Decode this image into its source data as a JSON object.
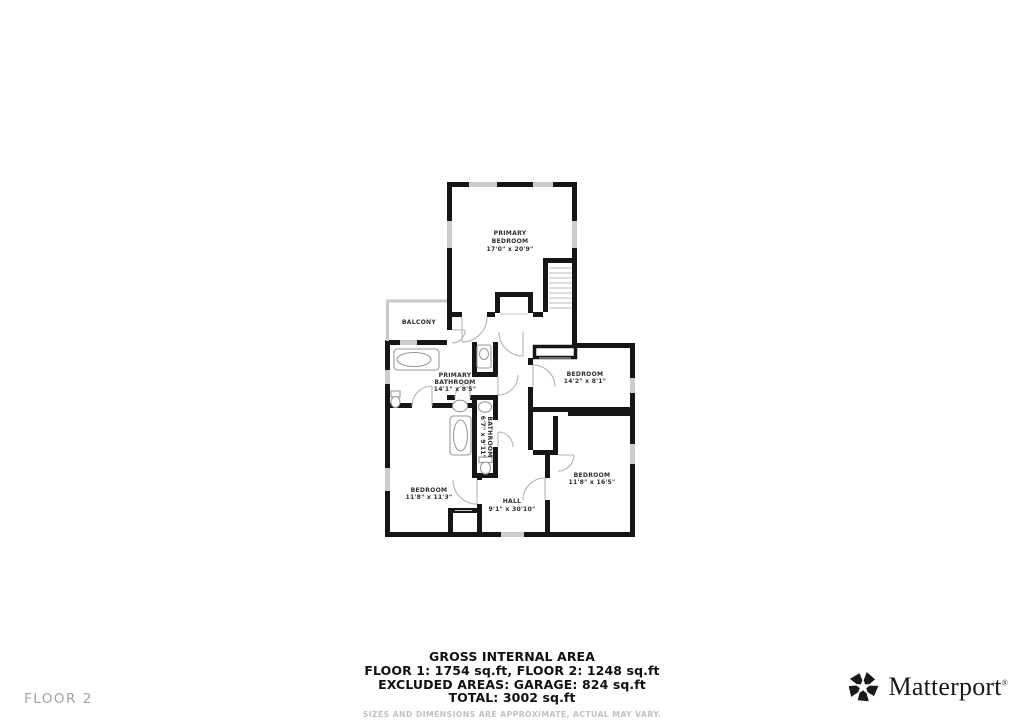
{
  "floor_label": "FLOOR 2",
  "rooms": {
    "primary_bedroom": {
      "line1": "PRIMARY",
      "line2": "BEDROOM",
      "dims": "17'0\" x 20'9\""
    },
    "balcony": {
      "name": "BALCONY"
    },
    "primary_bathroom": {
      "line1": "PRIMARY",
      "line2": "BATHROOM",
      "dims": "14'1\" x 8'5\""
    },
    "bathroom": {
      "name": "BATHROOM",
      "dims": "6'7\" x 9'11\""
    },
    "bedroom_top": {
      "name": "BEDROOM",
      "dims": "14'2\" x 8'1\""
    },
    "bedroom_left": {
      "name": "BEDROOM",
      "dims": "11'8\" x 11'3\""
    },
    "bedroom_right": {
      "name": "BEDROOM",
      "dims": "11'8\" x 16'5\""
    },
    "hall": {
      "name": "HALL",
      "dims": "9'1\" x 30'10\""
    }
  },
  "summary": {
    "title": "GROSS INTERNAL AREA",
    "line1": "FLOOR 1: 1754 sq.ft, FLOOR 2: 1248 sq.ft",
    "line2": "EXCLUDED AREAS: GARAGE: 824 sq.ft",
    "line3": "TOTAL: 3002 sq.ft",
    "disclaimer": "SIZES AND DIMENSIONS ARE APPROXIMATE, ACTUAL MAY VARY."
  },
  "brand": {
    "name": "Matterport",
    "registered": "®"
  },
  "colors": {
    "wall": "#161616",
    "window": "#cdcdcd",
    "fixture": "#9a9a9a",
    "door_arc": "#b5b5b5",
    "stair_tread": "#d0d0d0",
    "label": "#2e2e2e",
    "muted_text": "#a3a3a3"
  }
}
